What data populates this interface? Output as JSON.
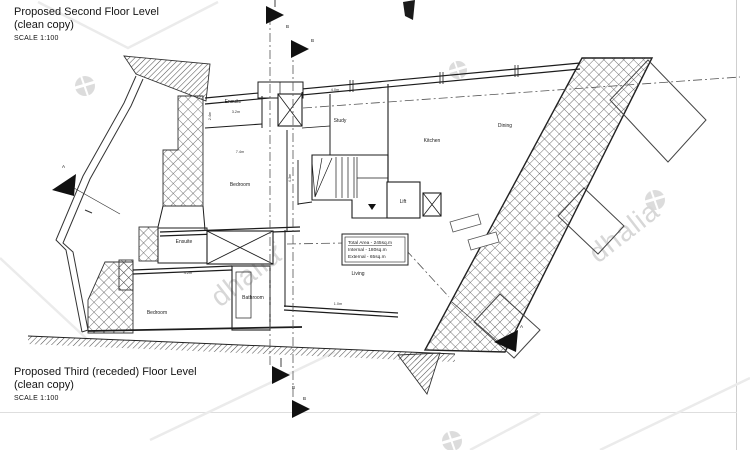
{
  "titles": {
    "second": {
      "line1": "Proposed Second Floor Level",
      "line2": "(clean copy)",
      "scale": "SCALE 1:100"
    },
    "third": {
      "line1": "Proposed Third (receded) Floor Level",
      "line2": "(clean copy)",
      "scale": "SCALE 1:100"
    }
  },
  "plan": {
    "rooms": [
      {
        "label": "Ensuite"
      },
      {
        "label": "Bedroom"
      },
      {
        "label": "Study"
      },
      {
        "label": "Kitchen"
      },
      {
        "label": "Dining"
      },
      {
        "label": "Lift"
      },
      {
        "label": "Ensuite"
      },
      {
        "label": "Bedroom"
      },
      {
        "label": "Bathroom"
      },
      {
        "label": "Living"
      }
    ],
    "annotation": {
      "line1": "Total Area - 245sq.m",
      "line2": "Internal - 180sq.m",
      "line3": "External - 65sq.m"
    },
    "section_markers": [
      {
        "label": "B"
      },
      {
        "label": "B"
      },
      {
        "label": "A"
      },
      {
        "label": "A"
      },
      {
        "label": "B"
      },
      {
        "label": "B"
      }
    ],
    "dims": [
      {
        "v": "3.2m"
      },
      {
        "v": "7.4m"
      },
      {
        "v": "4.2m"
      },
      {
        "v": "4.0m"
      },
      {
        "v": "1.0m"
      },
      {
        "v": "2.4m"
      },
      {
        "v": "4.3m"
      }
    ]
  },
  "watermark": {
    "text": "dhalia"
  },
  "colors": {
    "line": "#1c1c1c",
    "watermark": "#d7d7d7",
    "sheet_edge": "#cfcfcf"
  }
}
